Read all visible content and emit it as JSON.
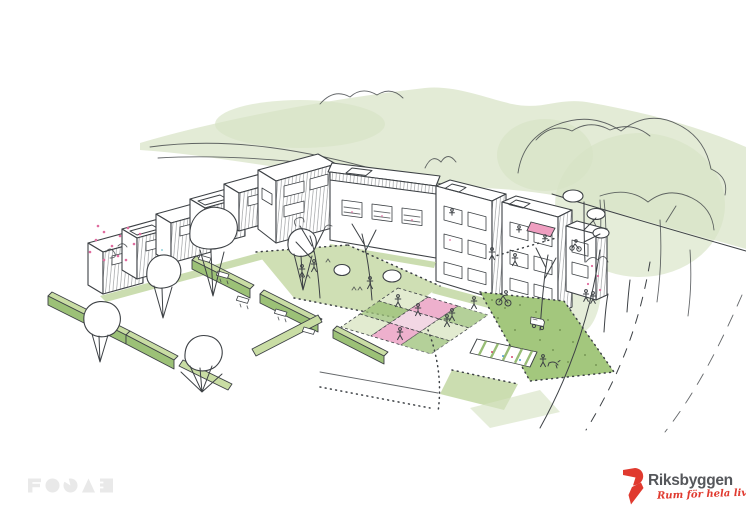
{
  "canvas": {
    "width": 746,
    "height": 528,
    "background": "#ffffff"
  },
  "palette": {
    "sketch_line": "#3d4145",
    "wash_green": "#e3ebd6",
    "wash_green_deep": "#d7e3c5",
    "lawn_green": "#cfdfb4",
    "lawn_green_light": "#e2ebd0",
    "hedge_top_green": "#c9dda4",
    "hedge_front_green": "#9cc177",
    "allotment_green": "#a3c77d",
    "bed_green": "#c2d7a2",
    "plot_pink": "#eeb0cd",
    "plot_pink_light": "#f2d7e4",
    "blossom_pink": "#e06c9f",
    "accent_blue": "#7ec8d4",
    "awning_pink": "#ef9ec0",
    "fojab_gray": "#e9e9e9",
    "brand_red": "#e03a2f",
    "wordmark_gray": "#55575b"
  },
  "logos": {
    "fojab": {
      "text": "FOJAB"
    },
    "riksbyggen": {
      "name": "Riksbyggen",
      "tagline": "Rum för hela livet"
    }
  }
}
